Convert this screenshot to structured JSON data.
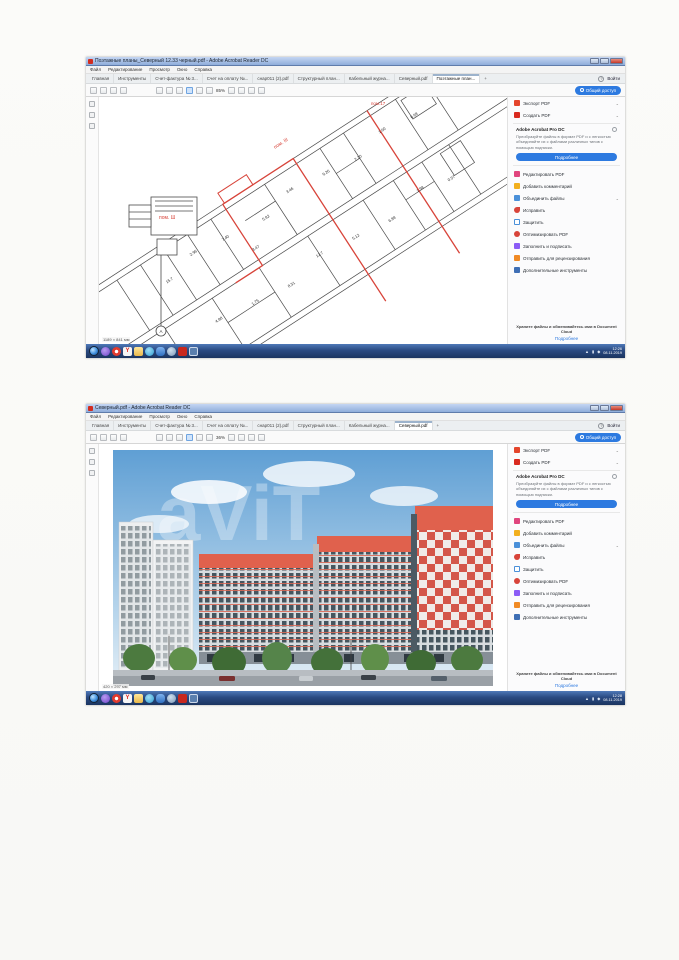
{
  "scan": {
    "watermark_text": "aViT"
  },
  "acrobat": {
    "menu": [
      "Файл",
      "Редактирование",
      "Просмотр",
      "Окно",
      "Справка"
    ],
    "signin_label": "Войти",
    "share_label": "Общий доступ",
    "panel": {
      "export_label": "Экспорт PDF",
      "create_label": "Создать PDF",
      "promo_title": "Adobe Acrobat Pro DC",
      "promo_text": "Преобразуйте файлы в формат PDF и с легкостью объединяйте их с файлами различных типов с помощью подписки.",
      "promo_button": "Подробнее",
      "items": [
        "Редактировать PDF",
        "Добавить комментарий",
        "Объединить файлы",
        "Исправить",
        "Защитить",
        "Оптимизировать PDF",
        "Заполнить и подписать",
        "Отправить для рецензирования",
        "Дополнительные инструменты"
      ],
      "footer_text": "Храните файлы и обменивайтесь ими в Document Cloud",
      "footer_link": "Подробнее"
    }
  },
  "windows": [
    {
      "title": "Поэтажные планы_Северный 12.33 черный.pdf - Adobe Acrobat Reader DC",
      "tabs": [
        "Главная",
        "Инструменты",
        "Счет-фактура № 3...",
        "Счет на оплату №...",
        "снар011 (2).pdf",
        "Структурный план...",
        "Кабельный журна...",
        "Северный.pdf",
        "Поэтажные план..."
      ],
      "new_tab": "+",
      "zoom_level": "85%",
      "page_size": "1189 × 841 мм",
      "clock_time": "12:26",
      "clock_date": "08.11.2019",
      "plan": {
        "label_top": "пом.17",
        "label_room_a": "пом. III",
        "label_room_b": "пом. Ш",
        "section_mark": "А",
        "dims": [
          "15.7",
          "2.96",
          "7.40",
          "5.82",
          "3.46",
          "9.26",
          "2.20",
          "1.60",
          "6.98",
          "4.88",
          "1.75",
          "8.31",
          "12.7",
          "5.12",
          "6.88",
          "1.98",
          "0.57",
          "3.47"
        ]
      }
    },
    {
      "title": "Северный.pdf - Adobe Acrobat Reader DC",
      "tabs": [
        "Главная",
        "Инструменты",
        "Счет-фактура № 3...",
        "Счет на оплату №...",
        "снар011 (2).pdf",
        "Структурный план...",
        "Кабельный журна...",
        "Северный.pdf"
      ],
      "new_tab": "+",
      "zoom_level": "36%",
      "page_size": "420 × 297 мм",
      "clock_time": "12:28",
      "clock_date": "08.11.2019"
    }
  ],
  "colors": {
    "accent_blue": "#2d7ae0",
    "acrobat_red": "#c8281e",
    "plan_highlight_red": "#d8443a",
    "building_coral": "#e0614d",
    "taskbar_blue": "#2a4a82"
  }
}
